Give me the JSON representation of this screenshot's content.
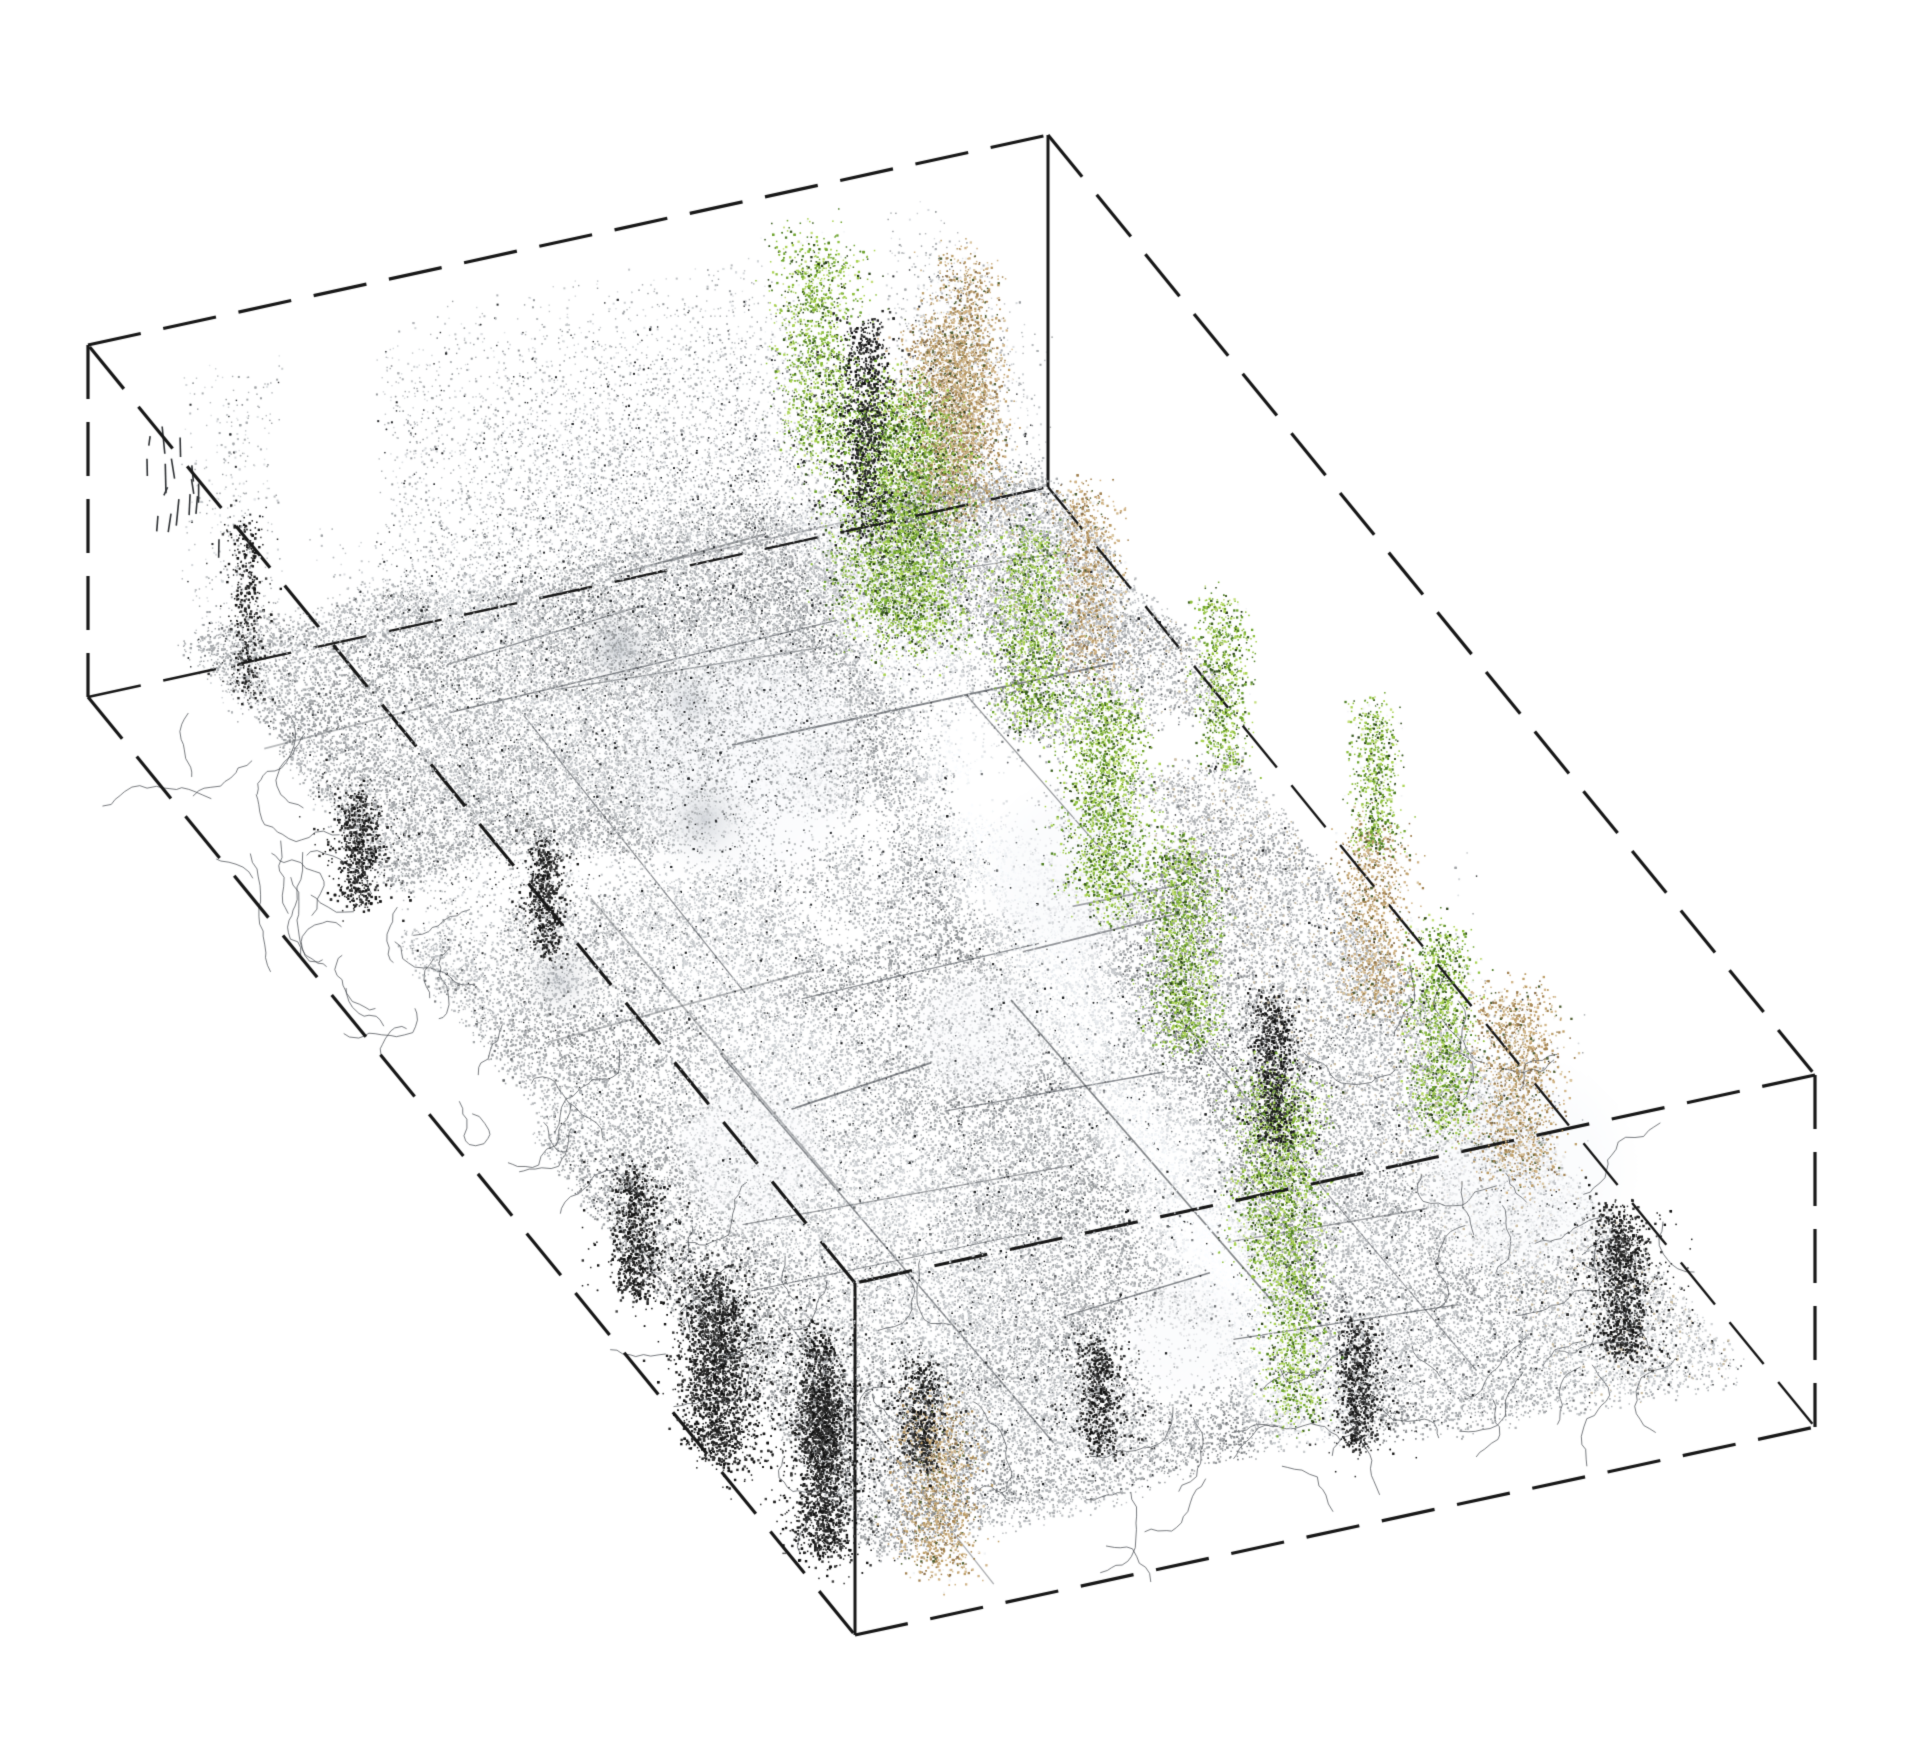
{
  "figure": {
    "kind": "3d-point-cloud-crop-with-bounding-box",
    "background": "#ffffff",
    "width": 1920,
    "height": 1759
  },
  "bounding_box": {
    "stroke": "#171717",
    "line_width": 3.2,
    "hidden_line_width": 2.4,
    "dash": [
      54,
      23
    ],
    "height_px": 352,
    "top_face": {
      "L": [
        88,
        345
      ],
      "T": [
        1048,
        135
      ],
      "R": [
        1815,
        1075
      ],
      "F": [
        855,
        1283
      ]
    },
    "bottom_face": {
      "L": [
        88,
        697
      ],
      "T": [
        1048,
        487
      ],
      "R": [
        1815,
        1427
      ],
      "F": [
        855,
        1635
      ]
    },
    "solid_verticals": [
      "T",
      "F"
    ],
    "hidden_bottom_edges": [
      [
        "L",
        "T"
      ],
      [
        "T",
        "R"
      ]
    ]
  },
  "point_cloud": {
    "seed": 42,
    "base_points": 92000,
    "elevated_points": 26000,
    "overlay_fraction": 0.18,
    "gray_tint": {
      "min_g": 72,
      "span_g": 186,
      "rgb_offsets": [
        -6,
        -3,
        0
      ],
      "dark_speckle_prob": 0.05,
      "black_speckle_prob": 0.018
    },
    "street_band": {
      "u_at_v0": 0.745,
      "slope": -0.22,
      "width": 0.05,
      "edge_dark_offset": 0.075
    },
    "second_band": {
      "u_at_v0": 0.36,
      "slope": -0.06,
      "width": 0.05
    },
    "palettes": {
      "greens": {
        "colors": [
          "#a8d24f",
          "#8cbe3a",
          "#6da32e",
          "#4d7d24",
          "#35571b",
          "#c3dd7a",
          "#243a12"
        ],
        "weights": [
          0.2,
          0.22,
          0.18,
          0.14,
          0.1,
          0.08,
          0.08
        ]
      },
      "tans": {
        "colors": [
          "#cfb285",
          "#bb9c66",
          "#a08050",
          "#d8c49e",
          "#8a6f4b",
          "#4a5a2e"
        ],
        "weights": [
          0.28,
          0.26,
          0.18,
          0.1,
          0.1,
          0.08
        ]
      },
      "darks": {
        "colors": [
          "#101010",
          "#1f1f1f",
          "#2f2f2f",
          "#3f3f3f"
        ],
        "weights": [
          0.35,
          0.3,
          0.2,
          0.15
        ]
      },
      "elevated_gray": {
        "min_g": 112,
        "span_g": 108
      }
    },
    "tree_clusters": [
      {
        "u": 0.68,
        "v": 0.21,
        "r": 0.075,
        "h0": 0.35,
        "h1": 1.0,
        "n": 5200
      },
      {
        "u": 0.72,
        "v": 0.05,
        "r": 0.05,
        "h0": 0.4,
        "h1": 1.0,
        "n": 1500
      },
      {
        "u": 0.71,
        "v": 0.34,
        "r": 0.04,
        "h0": 0.4,
        "h1": 0.95,
        "n": 1600
      },
      {
        "u": 0.66,
        "v": 0.5,
        "r": 0.05,
        "h0": 0.35,
        "h1": 0.95,
        "n": 2300
      },
      {
        "u": 0.63,
        "v": 0.64,
        "r": 0.042,
        "h0": 0.35,
        "h1": 0.9,
        "n": 1800
      },
      {
        "u": 0.56,
        "v": 0.85,
        "r": 0.05,
        "h0": 0.3,
        "h1": 0.85,
        "n": 2200
      },
      {
        "u": 0.48,
        "v": 0.97,
        "r": 0.035,
        "h0": 0.25,
        "h1": 0.7,
        "n": 1000
      },
      {
        "u": 0.77,
        "v": 0.8,
        "r": 0.038,
        "h0": 0.45,
        "h1": 1.0,
        "n": 1500
      },
      {
        "u": 0.83,
        "v": 0.44,
        "r": 0.03,
        "h0": 0.5,
        "h1": 0.95,
        "n": 900
      },
      {
        "u": 0.9,
        "v": 0.55,
        "r": 0.028,
        "h0": 0.5,
        "h1": 0.9,
        "n": 700
      }
    ],
    "tan_clusters": [
      {
        "u": 0.77,
        "v": 0.16,
        "r": 0.055,
        "h0": 0.5,
        "h1": 1.0,
        "n": 2600
      },
      {
        "u": 0.85,
        "v": 0.08,
        "r": 0.04,
        "h0": 0.4,
        "h1": 0.95,
        "n": 1200
      },
      {
        "u": 0.8,
        "v": 0.3,
        "r": 0.035,
        "h0": 0.4,
        "h1": 0.9,
        "n": 1000
      },
      {
        "u": 0.86,
        "v": 0.6,
        "r": 0.04,
        "h0": 0.2,
        "h1": 0.7,
        "n": 1200
      },
      {
        "u": 0.88,
        "v": 0.76,
        "r": 0.05,
        "h0": 0.15,
        "h1": 0.65,
        "n": 1600
      },
      {
        "u": 0.11,
        "v": 0.97,
        "r": 0.045,
        "h0": 0.05,
        "h1": 0.5,
        "n": 1400
      }
    ],
    "dark_clusters": [
      {
        "u": 0.005,
        "v": 0.81,
        "r": 0.055,
        "h0": 0.0,
        "h1": 0.5,
        "n": 2600
      },
      {
        "u": 0.03,
        "v": 0.92,
        "r": 0.04,
        "h0": 0.0,
        "h1": 0.45,
        "n": 1700
      },
      {
        "u": 0.1,
        "v": 0.83,
        "r": 0.03,
        "h0": 0.0,
        "h1": 0.35,
        "n": 800
      },
      {
        "u": 0.18,
        "v": 0.86,
        "r": 0.028,
        "h0": 0.0,
        "h1": 0.3,
        "n": 600
      },
      {
        "u": 0.05,
        "v": 0.65,
        "r": 0.03,
        "h0": 0.0,
        "h1": 0.35,
        "n": 900
      },
      {
        "u": 0.09,
        "v": 0.24,
        "r": 0.03,
        "h0": 0.0,
        "h1": 0.3,
        "n": 700
      },
      {
        "u": 0.22,
        "v": 0.32,
        "r": 0.025,
        "h0": 0.0,
        "h1": 0.3,
        "n": 600
      },
      {
        "u": 0.88,
        "v": 0.9,
        "r": 0.038,
        "h0": 0.0,
        "h1": 0.4,
        "n": 1300
      },
      {
        "u": 0.7,
        "v": 0.67,
        "r": 0.03,
        "h0": 0.1,
        "h1": 0.5,
        "n": 900
      },
      {
        "u": 0.73,
        "v": 0.1,
        "r": 0.035,
        "h0": 0.3,
        "h1": 0.9,
        "n": 1100
      },
      {
        "u": 0.14,
        "v": 0.03,
        "r": 0.02,
        "h0": 0.0,
        "h1": 0.5,
        "n": 400
      },
      {
        "u": 0.35,
        "v": 0.88,
        "r": 0.03,
        "h0": 0.0,
        "h1": 0.3,
        "n": 700
      },
      {
        "u": 0.58,
        "v": 0.93,
        "r": 0.03,
        "h0": 0.0,
        "h1": 0.35,
        "n": 800
      }
    ],
    "white_blobs": [
      {
        "x": 743,
        "y": 759,
        "r": 135,
        "a": 0.95
      },
      {
        "x": 1074,
        "y": 873,
        "r": 95,
        "a": 0.85
      },
      {
        "x": 1523,
        "y": 1170,
        "r": 115,
        "a": 0.85
      },
      {
        "x": 750,
        "y": 1158,
        "r": 85,
        "a": 0.7
      },
      {
        "x": 980,
        "y": 1035,
        "r": 75,
        "a": 0.7
      },
      {
        "x": 1185,
        "y": 1335,
        "r": 70,
        "a": 0.75
      }
    ],
    "gray_smudges": [
      {
        "x": 618,
        "y": 648,
        "r": 52,
        "c": "#b4bac2",
        "a": 0.65
      },
      {
        "x": 688,
        "y": 702,
        "r": 42,
        "c": "#c6cbd2",
        "a": 0.55
      },
      {
        "x": 705,
        "y": 820,
        "r": 55,
        "c": "#a7adb5",
        "a": 0.45
      },
      {
        "x": 560,
        "y": 980,
        "r": 48,
        "c": "#b0b6be",
        "a": 0.4
      }
    ],
    "struct_lines": {
      "count": 26,
      "color_rgb": [
        55,
        60,
        66
      ]
    },
    "branches": {
      "count": 95,
      "color": "rgba(62,66,72,0.78)",
      "regions": [
        {
          "u0": 0.0,
          "u1": 0.3,
          "v0": 0.55,
          "v1": 1.0
        },
        {
          "u0": 0.0,
          "u1": 0.1,
          "v0": 0.1,
          "v1": 0.55
        },
        {
          "u0": 0.3,
          "u1": 0.85,
          "v0": 0.88,
          "v1": 1.0
        },
        {
          "u0": 0.8,
          "u1": 1.0,
          "v0": 0.55,
          "v1": 0.95
        }
      ]
    },
    "wall_ticks": {
      "count": 16,
      "u0": 0.0,
      "u1": 0.04,
      "v0": 0.06,
      "v1": 0.14,
      "color": "#2e3134"
    }
  }
}
